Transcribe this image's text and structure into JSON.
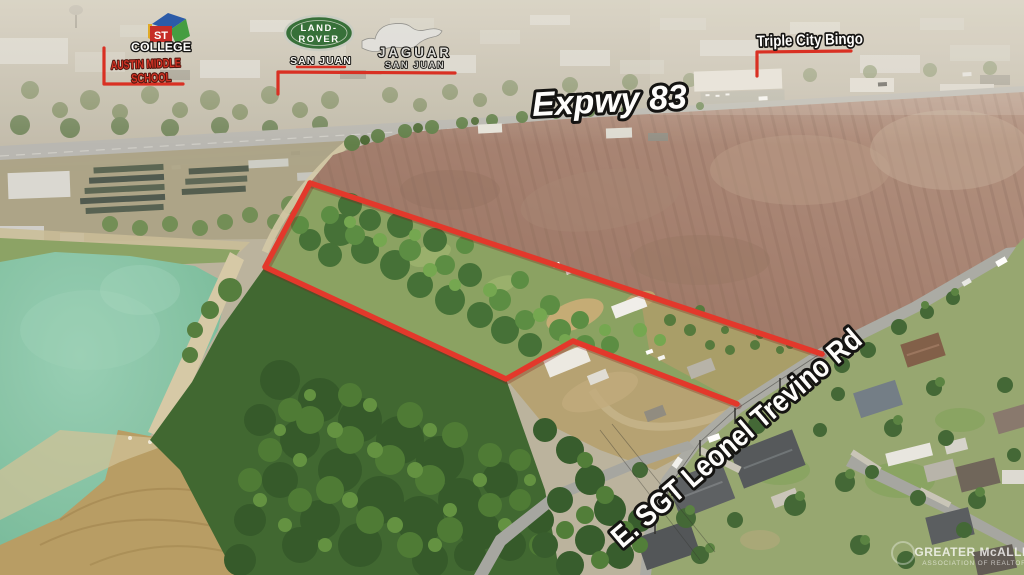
{
  "annotations": {
    "expressway_label": "Expwy 83",
    "road_label": "E. SGT Leonel Trevino Rd",
    "bingo": {
      "label": "Triple City Bingo"
    },
    "school": {
      "line1": "AUSTIN MIDDLE",
      "line2": "SCHOOL",
      "college": "COLLEGE",
      "logo_st": "ST"
    },
    "land_rover": {
      "line1": "LAND-",
      "line2": "ROVER",
      "city": "SAN JUAN"
    },
    "jaguar": {
      "name": "JAGUAR",
      "city": "SAN JUAN"
    }
  },
  "watermark": {
    "line1": "GREATER McALLEN",
    "line2": "ASSOCIATION OF REALTORS"
  },
  "boundary": {
    "color": "#e33024",
    "top_edge_points": "310,183 822,354",
    "west_south_points": "310,183 265,267 506,379 573,341 737,404",
    "school_bracket": "104,48 104,84 183,84",
    "dealership_bracket": "278,94 278,72 455,73",
    "bingo_bracket": "851,51 757,52 757,76",
    "landrover_underline": "297,67 345,67"
  },
  "palette": {
    "annotation_red": "#e33024",
    "plowed_field": "#9b7566",
    "pond_water": "#7fc4a7",
    "forest_green": "#38622b",
    "asphalt": "#a8a9a4",
    "haze": "#e8e4da"
  }
}
